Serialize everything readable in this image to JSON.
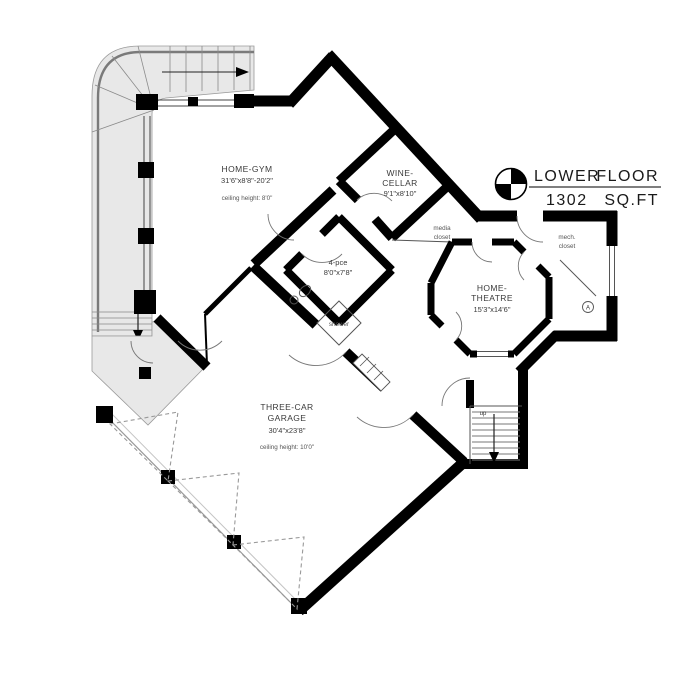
{
  "title_block": {
    "line1_left": "LOWER",
    "line1_right": "FLOOR",
    "line2_left": "1302",
    "line2_right": "SQ.FT",
    "compass_icon": "north-symbol"
  },
  "rooms": {
    "home_gym": {
      "name": "HOME-GYM",
      "dims": "31'6\"x8'8\"-20'2\"",
      "note": "ceiling height: 8'0\""
    },
    "wine_cellar": {
      "name_line1": "WINE-",
      "name_line2": "CELLAR",
      "dims": "9'1\"x8'10\""
    },
    "media_closet": {
      "line1": "media",
      "line2": "closet"
    },
    "mech_closet": {
      "line1": "mech.",
      "line2": "closet"
    },
    "home_theatre": {
      "name_line1": "HOME-",
      "name_line2": "THEATRE",
      "dims": "15'3\"x14'6\""
    },
    "bath": {
      "name": "4-pce",
      "dims": "8'0\"x7'8\""
    },
    "shower": {
      "name": "shower"
    },
    "garage": {
      "name_line1": "THREE-CAR",
      "name_line2": "GARAGE",
      "dims": "30'4\"x23'8\"",
      "note": "ceiling height: 10'0\""
    }
  },
  "stairs": {
    "up_label": "up"
  },
  "annotations": {
    "door_tag": "A"
  },
  "colors": {
    "wall": "#000000",
    "terrace_fill": "#e8e8e8",
    "thin_line": "#555555",
    "dash_line": "#999999"
  }
}
